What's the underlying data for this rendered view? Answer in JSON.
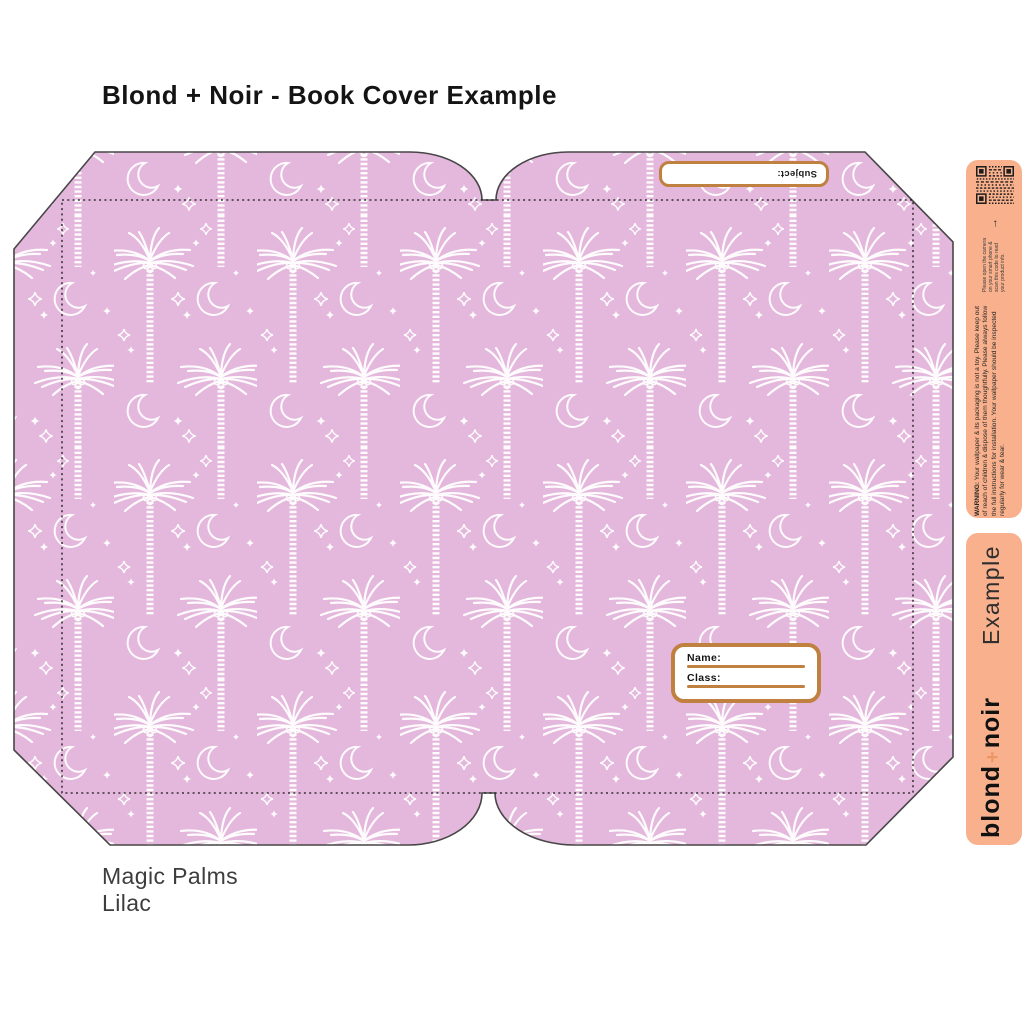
{
  "page": {
    "title": "Blond + Noir - Book Cover Example"
  },
  "cover": {
    "pattern_name": "magic-palms-lilac",
    "subject_label": "Subject:",
    "name_label": "Name:",
    "class_label": "Class:"
  },
  "product_caption": {
    "line1": "Magic Palms",
    "line2": "Lilac"
  },
  "info_strip": {
    "qr_caption": "Please open the camera on your smart phone & scan this code to read your product info.",
    "warning_prefix": "WARNING:",
    "warning_text": " Your wallpaper & its packaging is not a toy. Please keep out of reach of children & dispose of them thoughtfully. Please always follow the full instructions for installation. Your wallpaper should be inspected regularly for wear & tear."
  },
  "brand_strip": {
    "brand_word1": "blond",
    "brand_plus": "+",
    "brand_word2": "noir",
    "suffix": "Example"
  },
  "colors": {
    "lilac": "#e4b7dc",
    "peach": "#f8b18c",
    "caramel": "#c08140",
    "ink": "#1e1e1e",
    "motif": "#ffffff"
  }
}
